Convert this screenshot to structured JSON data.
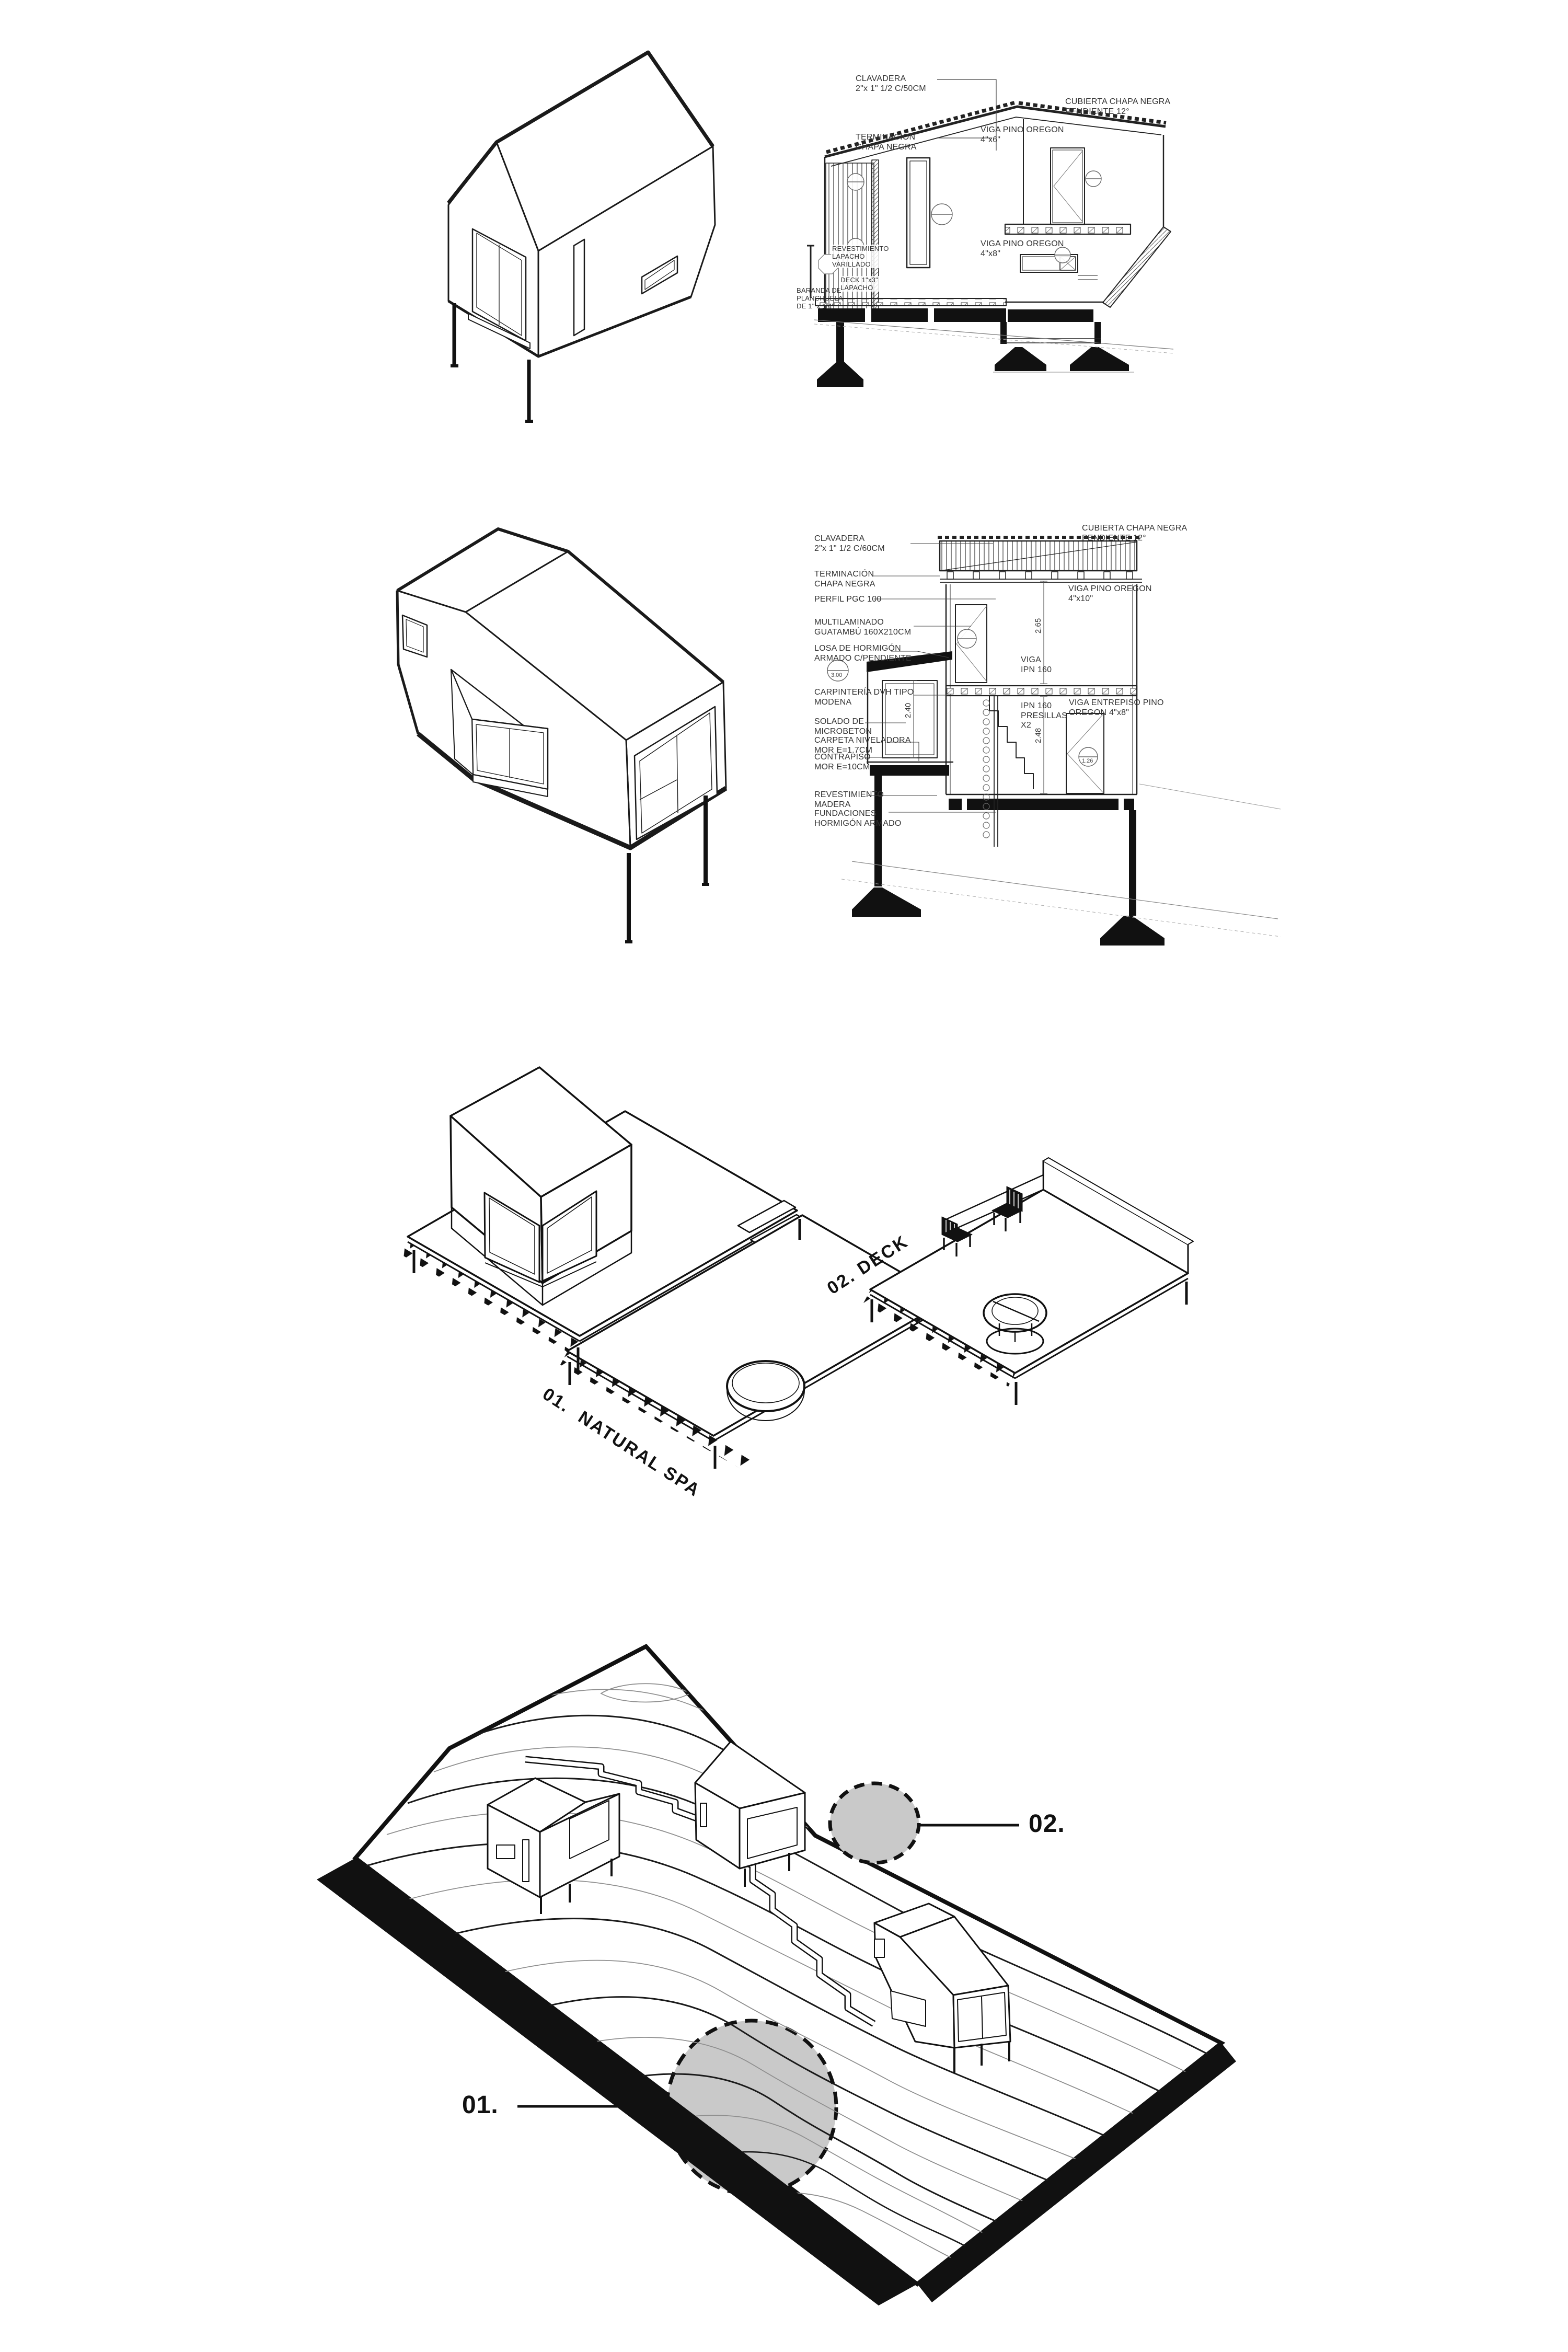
{
  "sheet": {
    "background": "#ffffff",
    "ink": "#1a1a1a",
    "muted": "#8f8f8f",
    "highlight": "#c9c9c9"
  },
  "panel1": {
    "labels": {
      "clavadera": {
        "l1": "CLAVADERA",
        "l2": "2\"x 1\" 1/2 C/50CM"
      },
      "terminacion": {
        "l1": "TERMINACIÓN",
        "l2": "CHAPA NEGRA"
      },
      "cubierta": {
        "l1": "CUBIERTA CHAPA NEGRA",
        "l2": "PENDIENTE 12°"
      },
      "viga_cubierta": {
        "l1": "VIGA PINO OREGON",
        "l2": "4\"x6\""
      },
      "revestimiento": {
        "l1": "REVESTIMIENTO",
        "l2": "LAPACHO",
        "l3": "VARILLADO"
      },
      "baranda": {
        "l1": "BARANDA DE",
        "l2": "PLANCHUELA",
        "l3": "DE 1\" x 1/4\""
      },
      "deck": {
        "l1": "DECK 1\"x3\"",
        "l2": "LAPACHO"
      },
      "viga_entrepiso": {
        "l1": "VIGA PINO OREGON",
        "l2": "4\"x8\""
      }
    }
  },
  "panel2": {
    "left_labels": [
      {
        "l1": "CLAVADERA",
        "l2": "2\"x 1\" 1/2 C/60CM"
      },
      {
        "l1": "TERMINACIÓN",
        "l2": "CHAPA NEGRA"
      },
      {
        "l1": "PERFIL PGC 100"
      },
      {
        "l1": "MULTILAMINADO",
        "l2": "GUATAMBÚ 160X210CM"
      },
      {
        "l1": "LOSA DE HORMIGÓN",
        "l2": "ARMADO C/PENDIENTE"
      },
      {
        "l1": "CARPINTERÍA DVH TIPO",
        "l2": "MODENA"
      },
      {
        "l1": "SOLADO DE",
        "l2": "MICROBETON"
      },
      {
        "l1": "CARPETA NIVELADORA",
        "l2": "MOR E=1.7CM"
      },
      {
        "l1": "CONTRAPISO",
        "l2": "MOR E=10CM"
      },
      {
        "l1": "REVESTIMIENTO",
        "l2": "MADERA"
      },
      {
        "l1": "FUNDACIONES",
        "l2": "HORMIGÓN ARMADO"
      }
    ],
    "right_labels": [
      {
        "l1": "CUBIERTA CHAPA NEGRA",
        "l2": "PENDIENTE 12°"
      },
      {
        "l1": "VIGA PINO OREGON",
        "l2": "4\"x10\""
      },
      {
        "l1": "VIGA ENTREPISO PINO",
        "l2": "OREGON 4\"x8\""
      },
      {
        "l1": "VIGA",
        "l2": "IPN 160"
      },
      {
        "l1": "IPN 160",
        "l2": "PRESILLAS",
        "l3": "X2"
      }
    ],
    "dims": {
      "upper": "2.65",
      "lower": "2.48",
      "window": "2.40"
    },
    "tags": {
      "losa": "3.00",
      "puerta": "1.26"
    }
  },
  "panel3": {
    "spa": "01.  NATURAL SPA",
    "deck": "02. DECK"
  },
  "panel4": {
    "n01": "01.",
    "n02": "02."
  }
}
